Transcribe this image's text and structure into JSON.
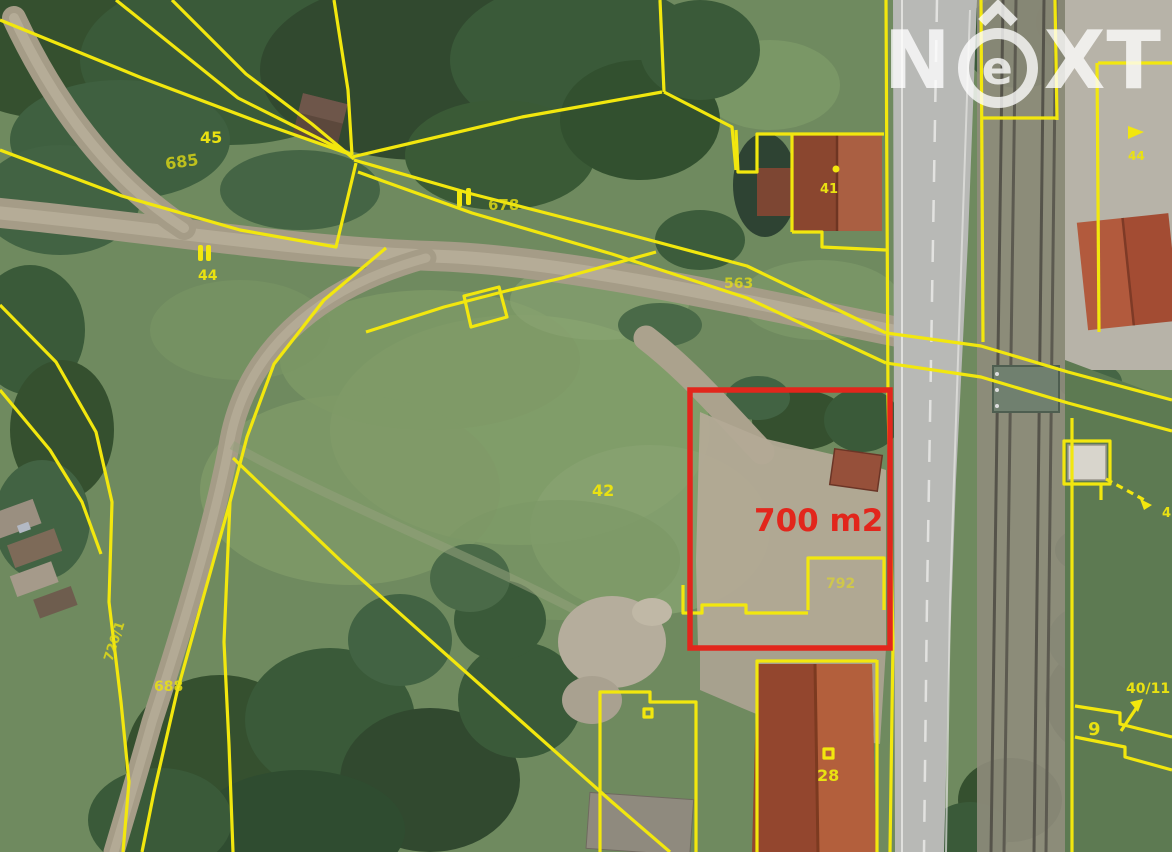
{
  "page": {
    "type": "aerial-cadastral-map",
    "description": "Aerial orthophoto with cadastral parcel overlay and highlighted plot"
  },
  "watermark": {
    "full_name": "NeXT",
    "letter_n": "N",
    "letter_e": "e",
    "letter_xt": "XT"
  },
  "highlight": {
    "area_label": "700 m2"
  },
  "theme": {
    "cadastral_yellow": "#f2e70e",
    "label_yellow": "#e9e112",
    "highlight_red": "#e2261c",
    "watermark_white": "#ffffff"
  },
  "map": {
    "parcel_labels": [
      {
        "text": "45"
      },
      {
        "text": "685"
      },
      {
        "text": "678"
      },
      {
        "text": "44"
      },
      {
        "text": "563"
      },
      {
        "text": "42"
      },
      {
        "text": "720/1"
      },
      {
        "text": "688"
      },
      {
        "text": "41"
      },
      {
        "text": "792"
      },
      {
        "text": "28"
      },
      {
        "text": "40/11"
      },
      {
        "text": "44"
      },
      {
        "text": "9"
      },
      {
        "text": "4"
      }
    ],
    "symbols": {
      "double_bar": "land-use double-bar symbol",
      "dot": "boundary point dot",
      "square": "building point symbol",
      "arrow": "parcel reference arrow"
    }
  }
}
